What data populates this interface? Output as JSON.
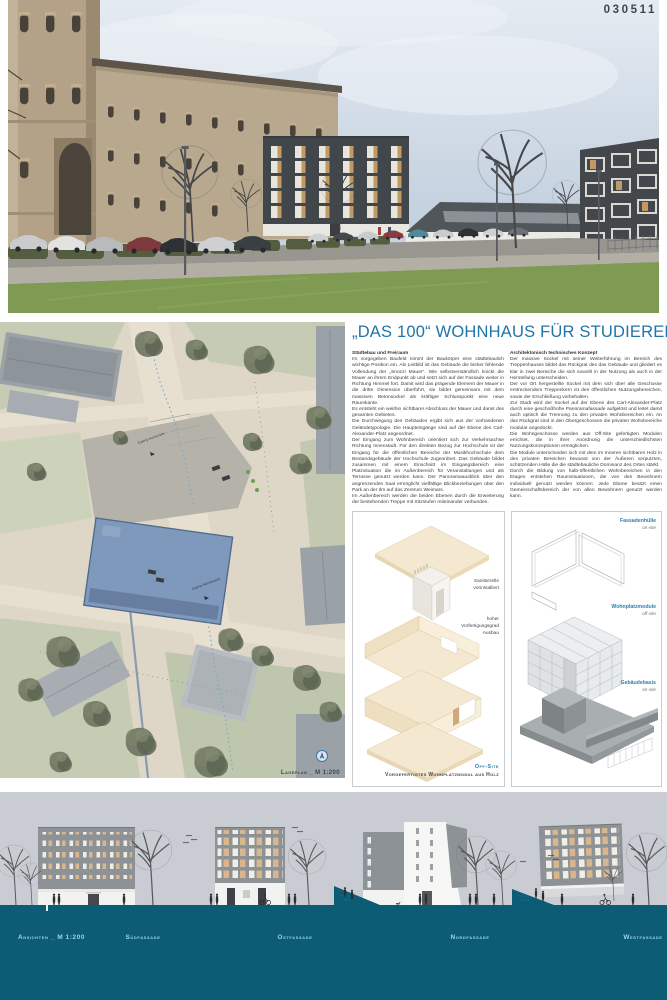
{
  "header": {
    "code": "030511"
  },
  "main": {
    "title": "„DAS 100“ WOHNHAUS FÜR STUDIERENDE",
    "columns": [
      {
        "heading": "Städtebau und Freiraum",
        "paragraphs": [
          "Im vorgegeben Baufeld nimmt der Baukörper eine städtebaulich wichtige Position ein. Als Leitbild ist das Gebäude die bisher fehlende Vollendung der „Snozzi Mauer“. Wie selbstverständlich knickt die Mauer an ihrem Endpunkt ab und setzt sich auf der Fassade weiter in Richtung Himmel fort. Damit wird das prägende Element der Mauer in die dritte Dimension überführt, sie bildet gemeinsam mit dem massiven Betonsockel als kräftiger Schlusspunkt eine neue Raumkante.",
          "Es entsteht ein weithin sichtbarer Abschluss der Mauer und damit des gesamten Gebietes.",
          "Die Durchwegung des Gebäudes ergibt sich aus der vorhandenen Geländetypologie. Die Haupteingänge sind auf der Ebene des Carl-Alexander-Platz angeordnet.",
          "Der Eingang zum Wohnbereich orientiert sich zur Verkehrsachse Richtung Innenstadt. Für den direkten Bezug zur Hochschule ist der Eingang für die öffentlichen Bereiche der Musikhochschule dem Bestandsgebäude der Hochschule zugeordnet. Das Gebäude bildet zusammen mit einem Einschnitt im Eingangsbereich eine Platzsituation die im Außenbereich für Veranstaltungen und als Terrasse genutzt werden kann. Der Panoramaausblick über den angrenzenden Saal ermöglicht vielfältige Blickbeziehungen über den Park an der Ilm auf das Zentrum Weimars.",
          "Im Außenbereich werden die beiden Ebenen durch die Erweiterung der bestehenden Treppe mit Sitzstufen miteinander verbunden."
        ]
      },
      {
        "heading": "Architektonisch technisches Konzept",
        "paragraphs": [
          "Der massive Sockel mit seiner Weiterführung im Bereich des Treppenhauses bildet das Rückgrat des das Gebäude und gliedert es klar in zwei Bereiche die sich sowohl in der Nutzung als auch in der Herstellung unterscheiden.",
          "Der vor Ort hergestellte Sockel mit dem sich über alle Geschosse erstreckendem Treppenkern ist den öffentlichen Nutzungsbereichen, sowie der Erschließung vorbehalten.",
          "Zur Stadt wird der Sockel auf der Ebene des Carl-Alexander-Platz durch eine geschoßhohe Panoramafassade aufgelöst und leitet damit auch optisch die Trennung zu den privaten Wohnbereichen ein. An das Rückgrat sind in den Obergeschossen die privaten Wohnbereiche modular angedockt.",
          "Die Wohngeschosse werden aus Off-Site gefertigten Modulen errichtet, die in ihrer Anordnung die unterschiedlichsten Nutzungskonzeptionen ermöglichen.",
          "Die Module unterscheiden sich mit dem im Inneren sichtbaren Holz in den privaten Bereichen bewusst von der Äußeren verputzten, schützenden Hülle die die städtebauliche Dominanz des Ortes stärkt.",
          "Durch die Bildung von halb-öffentlichen Wohnbereichen in den Etagen entstehen Raumsituationen, die von den Bewohnern individuell genutzt werden können. Jede Ebene besitzt einen Gemeinschaftsbereich der von allen Bewohnern genutzt werden kann."
        ]
      }
    ]
  },
  "siteplan": {
    "caption": "Lageplan _ M 1:200",
    "annotations": [
      "Zugang Hochschule",
      "Zugang Wohnbereich"
    ]
  },
  "module_diagram": {
    "label_sanitary": [
      "Sanitärzelle",
      "vorinstalliert"
    ],
    "label_prefab": [
      "hoher",
      "Vorfertigungsgrad",
      "Ausbau"
    ],
    "caption_mode": "Off-Site",
    "caption": "Vorgefertigtes Wohnplatzmodul aus Holz"
  },
  "assembly_diagram": {
    "steps": [
      {
        "label": "Fassadenhülle",
        "mode": "on-site"
      },
      {
        "label": "Wohnplatzmodule",
        "mode": "off-site"
      },
      {
        "label": "Gebäudebasis",
        "mode": "on-site"
      }
    ]
  },
  "elevations": {
    "scale_label": "Ansichten _ M 1:200",
    "facades": [
      "Südfassade",
      "Ostfassade",
      "Nordfassade",
      "Westfassade"
    ]
  },
  "colors": {
    "accent_blue": "#1f74a8",
    "label_blue": "#2e7fae",
    "band_teal": "#0b5c74",
    "band_text": "#9fd4e6",
    "module_beige": "#f3e7cf",
    "new_building_blue": "#7e99bb"
  }
}
